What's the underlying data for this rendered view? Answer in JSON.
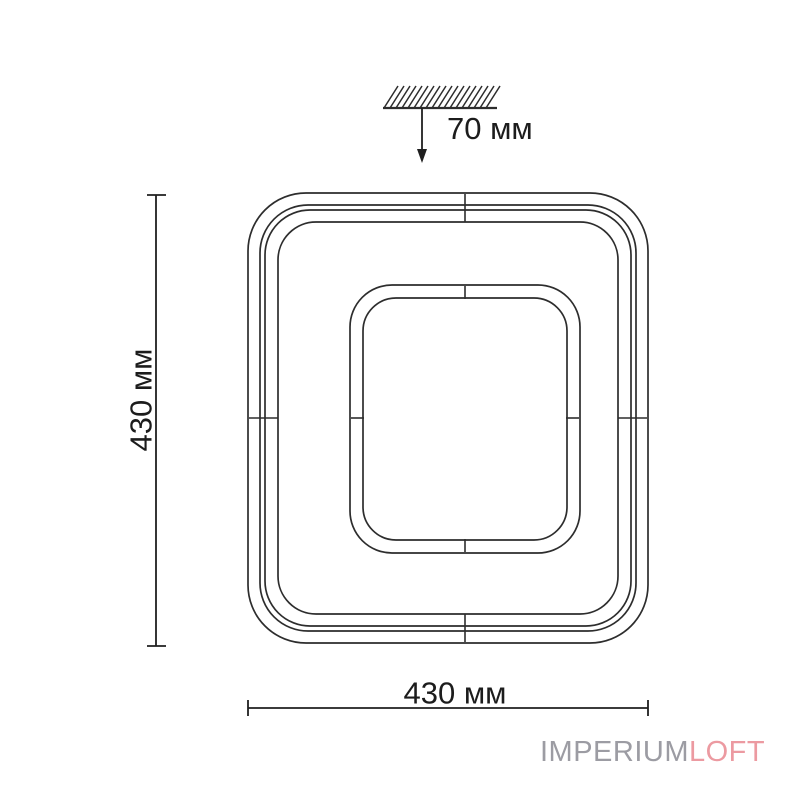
{
  "labels": {
    "ceiling_offset": "70 мм",
    "height": "430 мм",
    "width": "430 мм"
  },
  "watermark": {
    "primary": "IMPERIUM",
    "accent": "LOFT"
  },
  "colors": {
    "background": "#ffffff",
    "drawing_line": "#2d2d2d",
    "dimension_line": "#1f1f1f",
    "label_text": "#1c1c1c",
    "watermark_primary": "#9c9ca3",
    "watermark_accent": "#ec9aa1"
  }
}
